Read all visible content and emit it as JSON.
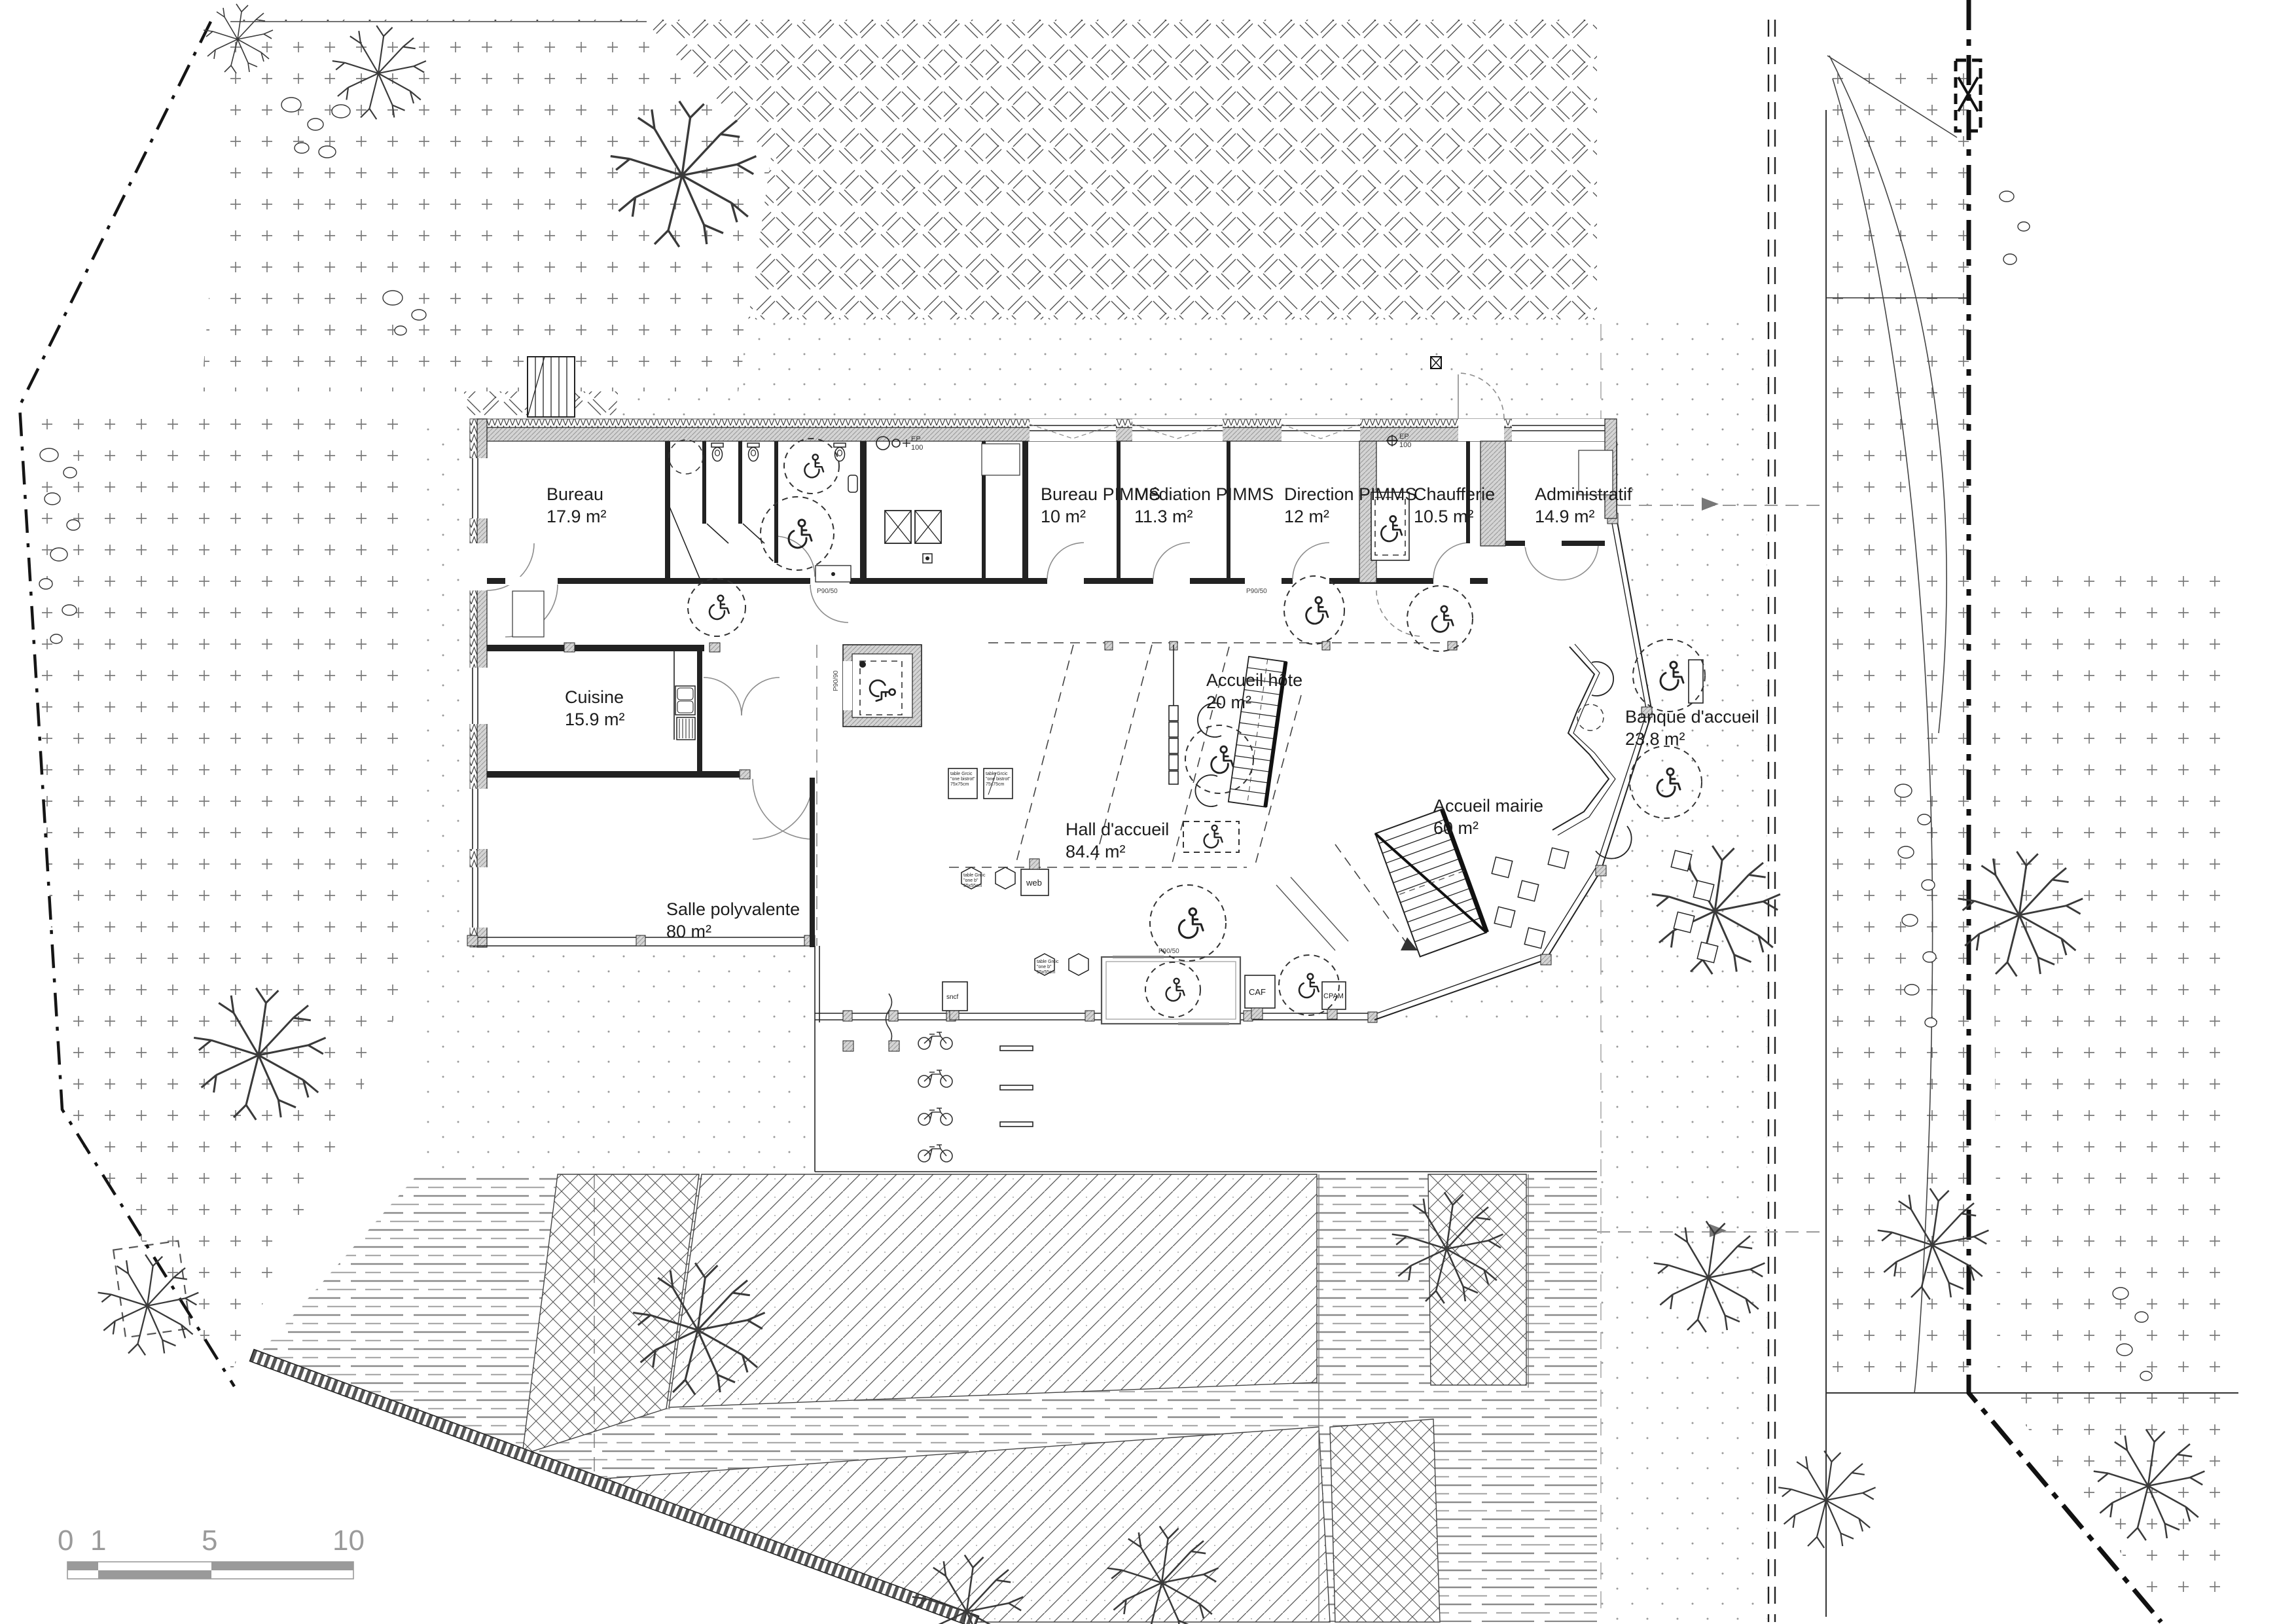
{
  "drawing": {
    "rooms": [
      {
        "id": "bureau",
        "name": "Bureau",
        "area": "17.9 m²"
      },
      {
        "id": "bureau-pimms",
        "name": "Bureau PIMMS",
        "area": "10 m²"
      },
      {
        "id": "mediation-pimms",
        "name": "Médiation PIMMS",
        "area": "11.3 m²"
      },
      {
        "id": "direction-pimms",
        "name": "Direction PIMMS",
        "area": "12 m²"
      },
      {
        "id": "chaufferie",
        "name": "Chaufferie",
        "area": "10.5 m²"
      },
      {
        "id": "administratif",
        "name": "Administratif",
        "area": "14.9 m²"
      },
      {
        "id": "cuisine",
        "name": "Cuisine",
        "area": "15.9 m²"
      },
      {
        "id": "accueil-hote",
        "name": "Accueil hôte",
        "area": "20 m²"
      },
      {
        "id": "accueil-mairie",
        "name": "Accueil mairie",
        "area": "60 m²"
      },
      {
        "id": "banque-accueil",
        "name": "Banque d'accueil",
        "area": "23.8 m²"
      },
      {
        "id": "salle-polyvalente",
        "name": "Salle polyvalente",
        "area": "80 m²"
      },
      {
        "id": "hall-accueil",
        "name": "Hall d'accueil",
        "area": "84.4 m²"
      }
    ],
    "labels": {
      "web": "web",
      "caf": "CAF",
      "cpam": "CPAM",
      "sncf": "sncf",
      "ep": "EP",
      "ep_size": "100",
      "door_tag": "P90/50",
      "door_tag_lift": "P90/90"
    },
    "annotations": {
      "bistrot_l1": "table Grcic",
      "bistrot_l2": "\"one bistrot\"",
      "bistrot_l3": "75x75cm",
      "hex_l1": "table Grcic",
      "hex_l2": "\"one b\"",
      "hex_l3": "55x55cm"
    },
    "scale_bar": {
      "ticks": [
        "0",
        "1",
        "5",
        "10"
      ]
    }
  }
}
